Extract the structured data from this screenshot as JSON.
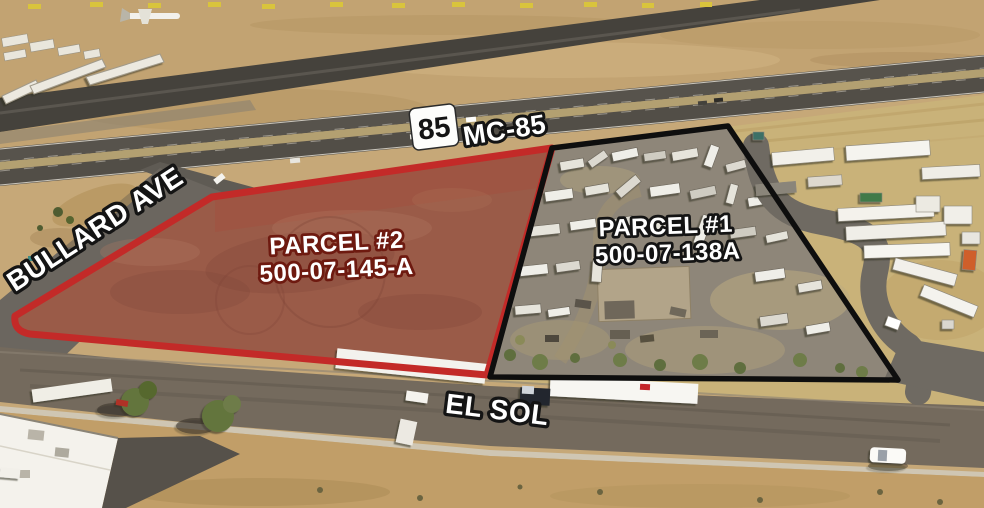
{
  "labels": {
    "route_shield": "85",
    "highway": "MC-85",
    "bullard_ave": "BULLARD AVE",
    "el_sol": "EL SOL",
    "parcel2_name": "PARCEL #2",
    "parcel2_apn": "500-07-145-A",
    "parcel1_name": "PARCEL #1",
    "parcel1_apn": "500-07-138A"
  },
  "colors": {
    "parcel2_outline": "#c32a28",
    "parcel1_outline": "#0e0e0e",
    "parcel2_label_outline": "#6e1a10",
    "dark_label_outline": "#141414",
    "label_text": "#ffffff"
  }
}
